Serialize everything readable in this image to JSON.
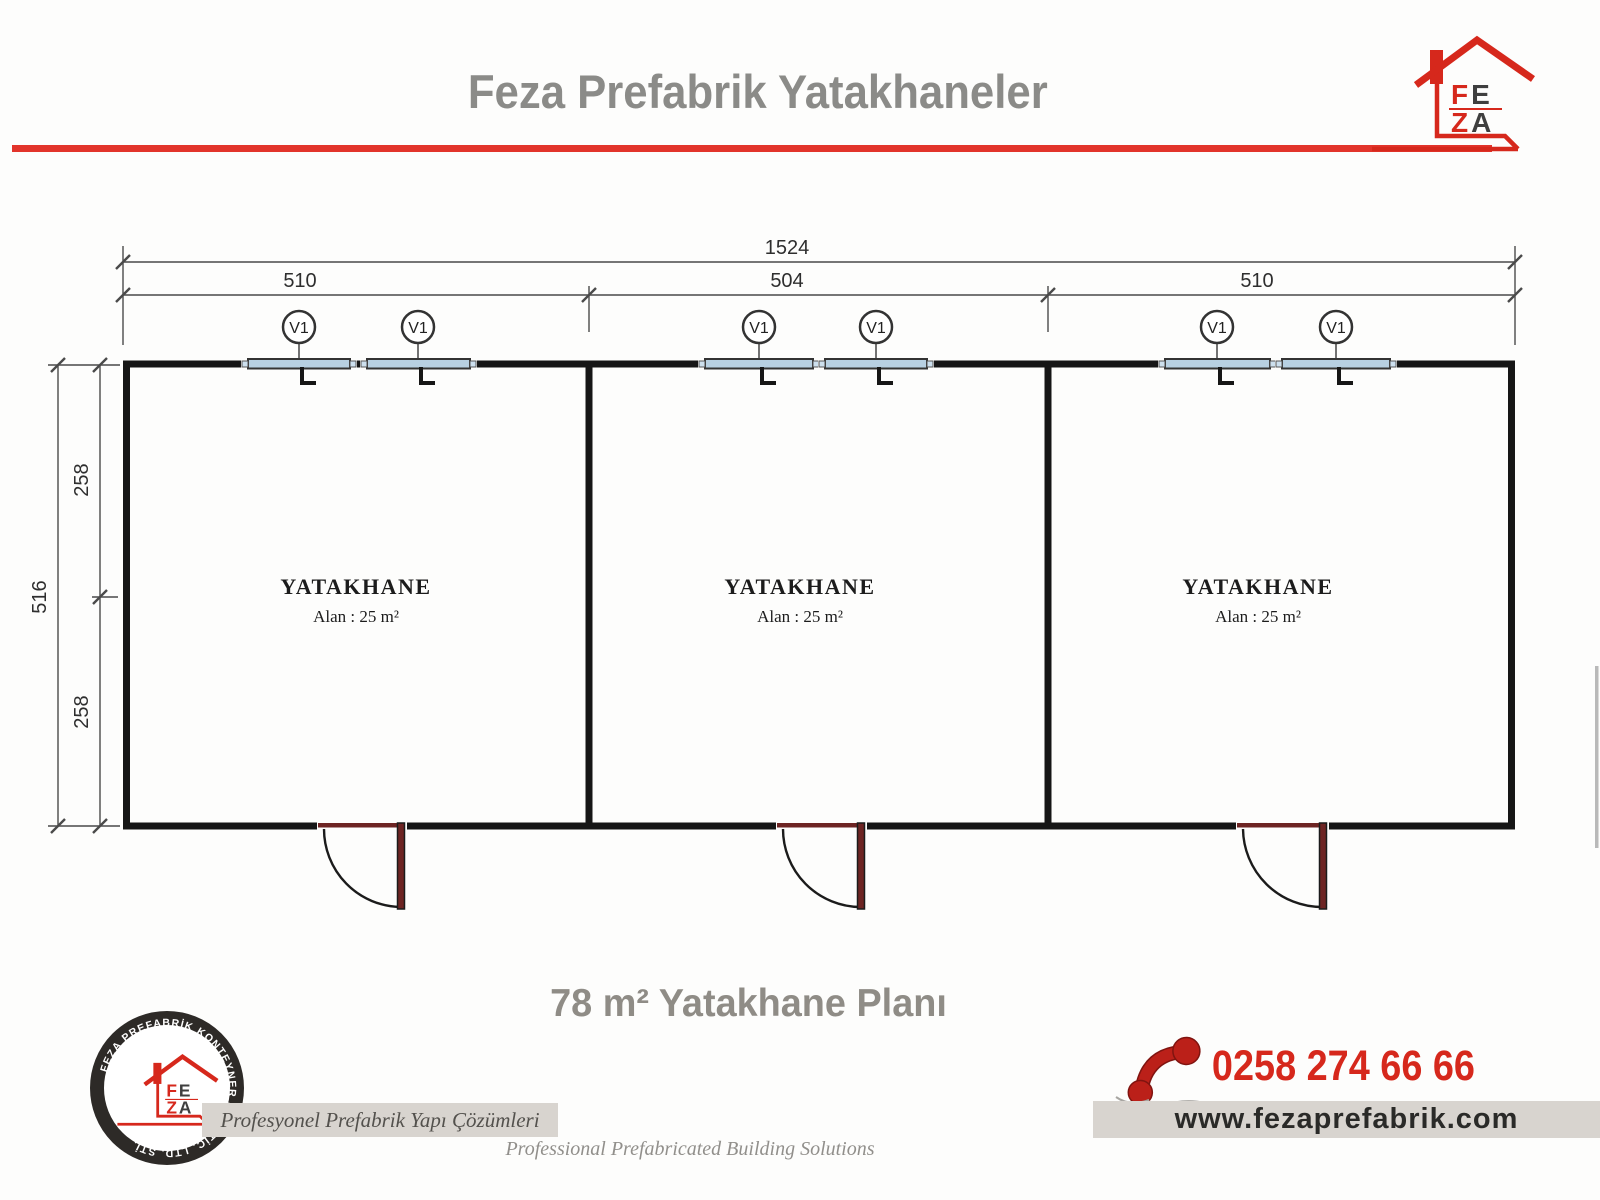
{
  "header": {
    "title": "Feza Prefabrik Yatakhaneler"
  },
  "brand": {
    "f": "F",
    "e": "E",
    "z": "Z",
    "a": "A"
  },
  "plan": {
    "dims": {
      "total_width": "1524",
      "room1_width": "510",
      "room2_width": "504",
      "room3_width": "510",
      "total_height": "516",
      "upper_height": "258",
      "lower_height": "258"
    },
    "window_label": "V1",
    "rooms": [
      {
        "name": "YATAKHANE",
        "area": "Alan : 25 m²"
      },
      {
        "name": "YATAKHANE",
        "area": "Alan : 25 m²"
      },
      {
        "name": "YATAKHANE",
        "area": "Alan : 25 m²"
      }
    ]
  },
  "footer": {
    "plan_title": "78 m² Yatakhane Planı",
    "phone": "0258 274 66 66",
    "website": "www.fezaprefabrik.com",
    "slogan_tr": "Profesyonel Prefabrik Yapı Çözümleri",
    "slogan_en": "Professional Prefabricated Building Solutions",
    "seal_text": "FEZA PREFABRİK KONTEYNER SAN. TİC. LTD. ŞTİ."
  },
  "colors": {
    "accent_red": "#e2342b",
    "brand_red": "#d6281c",
    "wall_black": "#161616",
    "window_blue": "#b7d0e2",
    "door_maroon": "#6d2423",
    "banner_gray": "#d8d4cf",
    "title_gray": "#8b8b88",
    "phone_red": "#d6281c",
    "website_text": "#2a2a28"
  }
}
